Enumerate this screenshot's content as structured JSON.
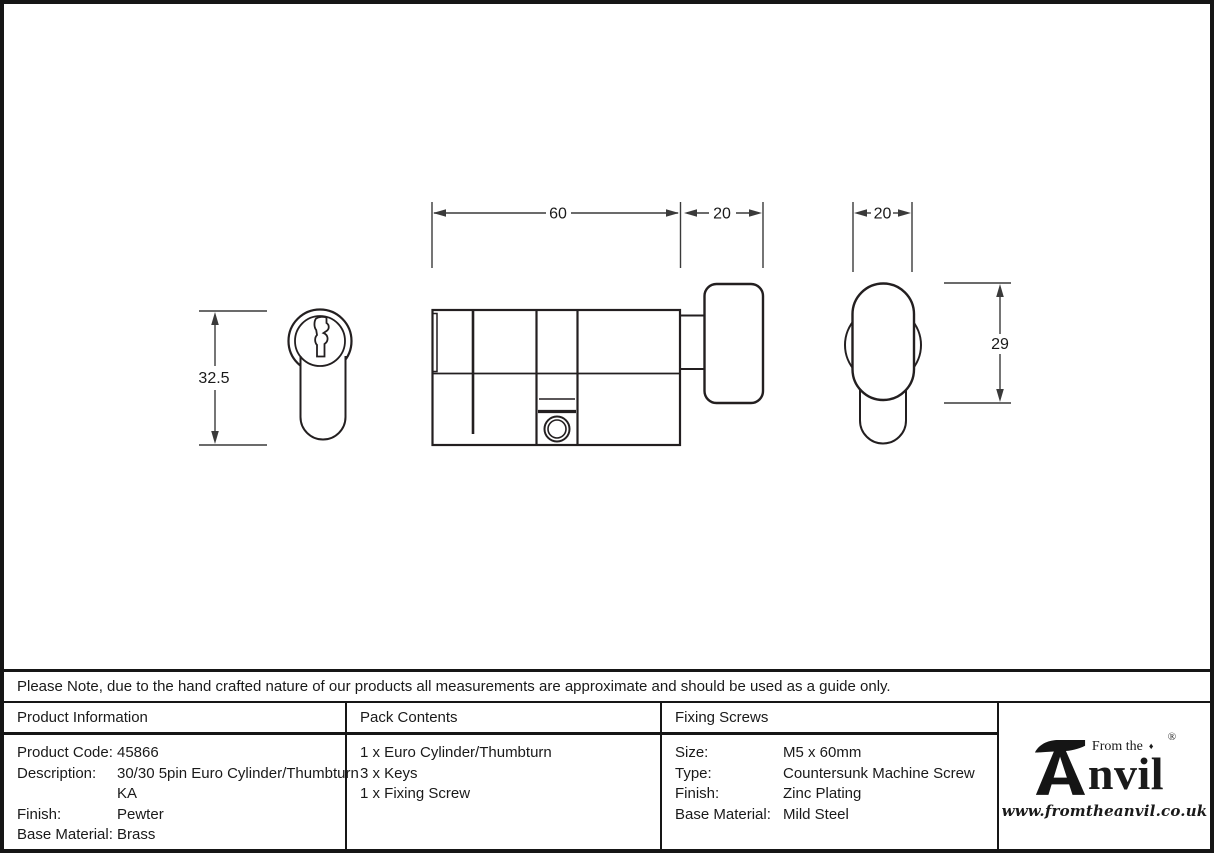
{
  "note": {
    "text": "Please Note, due to the hand crafted nature of our products all measurements are approximate and should be used as a guide only."
  },
  "drawing": {
    "dimensions": {
      "cylinder_length": "60",
      "thumbturn_depth": "20",
      "thumbturn_width": "20",
      "cylinder_height": "32.5",
      "thumbturn_height": "29"
    }
  },
  "tables": {
    "product_information": {
      "header": "Product Information",
      "rows": [
        {
          "label": "Product Code:",
          "value": "45866"
        },
        {
          "label": "Description:",
          "value": "30/30 5pin Euro Cylinder/Thumbturn"
        },
        {
          "label": "",
          "value": "KA"
        },
        {
          "label": "Finish:",
          "value": "Pewter"
        },
        {
          "label": "Base Material:",
          "value": "Brass"
        }
      ]
    },
    "pack_contents": {
      "header": "Pack Contents",
      "items": [
        "1 x Euro Cylinder/Thumbturn",
        "3 x Keys",
        "1 x Fixing Screw"
      ]
    },
    "fixing_screws": {
      "header": "Fixing Screws",
      "rows": [
        {
          "label": "Size:",
          "value": "M5 x 60mm"
        },
        {
          "label": "Type:",
          "value": "Countersunk Machine Screw"
        },
        {
          "label": "Finish:",
          "value": "Zinc Plating"
        },
        {
          "label": "Base Material:",
          "value": "Mild Steel"
        }
      ]
    }
  },
  "logo": {
    "tagline": "From the",
    "diamond": "♦",
    "name_rest": "nvil",
    "registered": "®",
    "website": "www.fromtheanvil.co.uk"
  },
  "colors": {
    "line": "#231f20",
    "dimension": "#3a3a3a",
    "border": "#161616"
  }
}
